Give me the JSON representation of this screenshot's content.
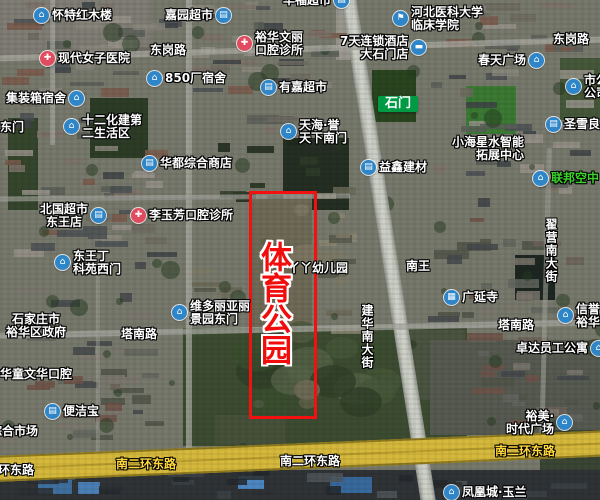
{
  "map": {
    "highlight": {
      "text": "体育公园",
      "color": "#f20d0d",
      "rect": {
        "x": 249,
        "y": 191,
        "w": 62,
        "h": 222
      },
      "text_pos": {
        "x": 257,
        "y": 241
      }
    },
    "colors": {
      "poi_icon_blue": "#2e86c8",
      "medical_icon_red": "#e14b5f",
      "tag_green": "#009944",
      "road_label_yellow": "#ffd83d",
      "green_poi_text": "#3bd42c",
      "expressway_yellow": "#d6b93c"
    },
    "labels": [
      {
        "name": "poi-huaite-hongmulou",
        "kind": "poi",
        "icon": "house",
        "side": "left",
        "x": 34,
        "y": 8,
        "lines": [
          "怀特红木楼"
        ]
      },
      {
        "name": "poi-jiayuan-supermarket",
        "kind": "poi",
        "icon": "shop",
        "side": "right",
        "x": 165,
        "y": 8,
        "lines": [
          "嘉园超市"
        ]
      },
      {
        "name": "poi-huafu-supermarket",
        "kind": "poi",
        "icon": "shop",
        "side": "right",
        "x": 283,
        "y": -7,
        "lines": [
          "华福超市"
        ]
      },
      {
        "name": "poi-hebei-medical-college",
        "kind": "poi",
        "icon": "school",
        "side": "left",
        "x": 393,
        "y": 6,
        "lines": [
          "河北医科大学",
          "临床学院"
        ]
      },
      {
        "name": "road-donggang-left",
        "kind": "road",
        "x": 150,
        "y": 44,
        "lines": [
          "东岗路"
        ]
      },
      {
        "name": "road-donggang-right",
        "kind": "road",
        "x": 553,
        "y": 33,
        "lines": [
          "东岗路"
        ]
      },
      {
        "name": "poi-xiandai-women-hospital",
        "kind": "poi",
        "icon": "medical",
        "side": "left",
        "x": 40,
        "y": 51,
        "lines": [
          "现代女子医院"
        ]
      },
      {
        "name": "poi-yuhua-wenli-dental",
        "kind": "poi",
        "icon": "medical",
        "side": "left",
        "x": 237,
        "y": 31,
        "lines": [
          "裕华文丽",
          "口腔诊所"
        ]
      },
      {
        "name": "poi-7days-hotel",
        "kind": "poi",
        "icon": "hotel",
        "side": "right",
        "align": "right",
        "x": 340,
        "y": 35,
        "lines": [
          "7天连锁酒店",
          "大石门店"
        ]
      },
      {
        "name": "poi-850-dorm",
        "kind": "poi",
        "icon": "house",
        "side": "left",
        "x": 147,
        "y": 71,
        "lines": [
          "850厂宿舍"
        ]
      },
      {
        "name": "poi-jizhuangxiang-dorm",
        "kind": "poi",
        "icon": "house",
        "side": "right",
        "x": 6,
        "y": 91,
        "lines": [
          "集装箱宿舍"
        ]
      },
      {
        "name": "poi-youjia-supermarket",
        "kind": "poi",
        "icon": "shop",
        "side": "left",
        "x": 261,
        "y": 80,
        "lines": [
          "有嘉超市"
        ]
      },
      {
        "name": "poi-chuntian-plaza",
        "kind": "poi",
        "icon": "house",
        "side": "right",
        "x": 478,
        "y": 53,
        "lines": [
          "春天广场"
        ]
      },
      {
        "name": "poi-shi-gong-company",
        "kind": "poi",
        "icon": "house",
        "side": "left",
        "x": 566,
        "y": 74,
        "lines": [
          "市公",
          "公司"
        ]
      },
      {
        "name": "tag-shimen",
        "kind": "tag",
        "x": 378,
        "y": 96,
        "lines": [
          "石门"
        ]
      },
      {
        "name": "poi-shierhuajian-living-area",
        "kind": "poi",
        "icon": "house",
        "side": "left",
        "x": 64,
        "y": 114,
        "lines": [
          "十二化建第",
          "二生活区"
        ]
      },
      {
        "name": "road-dongmen",
        "kind": "road",
        "x": 0,
        "y": 121,
        "lines": [
          "东门"
        ]
      },
      {
        "name": "poi-tianhai-yutianxia-south-gate",
        "kind": "poi",
        "icon": "house",
        "side": "left",
        "x": 281,
        "y": 119,
        "lines": [
          "天海·誉",
          "天下南门"
        ]
      },
      {
        "name": "poi-shengxueliang",
        "kind": "poi",
        "icon": "shop",
        "side": "left",
        "x": 546,
        "y": 117,
        "lines": [
          "圣雪良"
        ]
      },
      {
        "name": "poi-xiaohaixing-center",
        "kind": "poi",
        "align": "right",
        "x": 452,
        "y": 136,
        "lines": [
          "小海星水智能",
          "拓展中心"
        ]
      },
      {
        "name": "poi-huadu-store",
        "kind": "poi",
        "icon": "shop",
        "side": "left",
        "x": 142,
        "y": 156,
        "lines": [
          "华都综合商店"
        ]
      },
      {
        "name": "poi-yixin-building-materials",
        "kind": "poi",
        "icon": "shop",
        "side": "left",
        "x": 361,
        "y": 160,
        "lines": [
          "益鑫建材"
        ]
      },
      {
        "name": "poi-lianbang-kongzhong",
        "kind": "poi_green",
        "icon": "house",
        "side": "left",
        "x": 533,
        "y": 171,
        "lines": [
          "联邦空中"
        ]
      },
      {
        "name": "poi-beiguo-supermarket-dongwang",
        "kind": "poi",
        "icon": "shop",
        "side": "right",
        "align": "center",
        "x": 40,
        "y": 203,
        "lines": [
          "北国超市",
          "东王店"
        ]
      },
      {
        "name": "poi-liyufang-dental",
        "kind": "poi",
        "icon": "medical",
        "side": "left",
        "x": 131,
        "y": 208,
        "lines": [
          "李玉芳口腔诊所"
        ]
      },
      {
        "name": "road-zhaiying-south-street",
        "kind": "road_vertical",
        "x": 544,
        "y": 218,
        "lines": [
          "翟营南大街"
        ]
      },
      {
        "name": "poi-dongwang-keyuan-west-gate",
        "kind": "poi",
        "icon": "house",
        "side": "left",
        "x": 55,
        "y": 250,
        "lines": [
          "东王丁",
          "科苑西门"
        ]
      },
      {
        "name": "road-nanwang",
        "kind": "road",
        "x": 406,
        "y": 260,
        "lines": [
          "南王"
        ]
      },
      {
        "name": "poi-yaya-kindergarten",
        "kind": "poi",
        "x": 288,
        "y": 262,
        "lines": [
          "丫丫幼儿园"
        ]
      },
      {
        "name": "poi-guangyan-temple",
        "kind": "poi",
        "icon": "temple",
        "side": "left",
        "x": 444,
        "y": 290,
        "lines": [
          "广延寺"
        ]
      },
      {
        "name": "poi-victoria-gardens-east-gate",
        "kind": "poi",
        "icon": "house",
        "side": "left",
        "x": 172,
        "y": 300,
        "lines": [
          "维多丽亚丽",
          "景园东门"
        ]
      },
      {
        "name": "poi-xinyu-yuhua",
        "kind": "poi",
        "icon": "house",
        "side": "left",
        "x": 558,
        "y": 303,
        "lines": [
          "信誉",
          "裕华"
        ]
      },
      {
        "name": "road-jianhua-south-street",
        "kind": "road_vertical",
        "x": 360,
        "y": 304,
        "lines": [
          "建华南大街"
        ]
      },
      {
        "name": "poi-shijiazhuang-yuhua-gov",
        "kind": "poi",
        "align": "center",
        "x": 6,
        "y": 313,
        "lines": [
          "石家庄市",
          "裕华区政府"
        ]
      },
      {
        "name": "road-tananlu-left",
        "kind": "road",
        "x": 121,
        "y": 328,
        "lines": [
          "塔南路"
        ]
      },
      {
        "name": "road-tananlu-right",
        "kind": "road",
        "x": 498,
        "y": 319,
        "lines": [
          "塔南路"
        ]
      },
      {
        "name": "poi-zhuoda-staff-apartment",
        "kind": "poi",
        "icon": "house",
        "side": "right",
        "x": 516,
        "y": 341,
        "lines": [
          "卓达员工公寓"
        ]
      },
      {
        "name": "poi-yuhuatong-wenhua-dental",
        "kind": "poi",
        "x": -12,
        "y": 368,
        "lines": [
          "裕华童文华口腔"
        ]
      },
      {
        "name": "poi-bianjiebao",
        "kind": "poi",
        "icon": "shop",
        "side": "left",
        "x": 45,
        "y": 404,
        "lines": [
          "便洁宝"
        ]
      },
      {
        "name": "poi-zonghe-market",
        "kind": "poi",
        "x": -10,
        "y": 425,
        "lines": [
          "综合市场"
        ]
      },
      {
        "name": "poi-yumei-times-plaza",
        "kind": "poi",
        "icon": "house",
        "side": "right",
        "align": "right",
        "x": 506,
        "y": 410,
        "lines": [
          "裕美·",
          "时代广场"
        ]
      },
      {
        "name": "road-nanerhuan-left",
        "kind": "road",
        "x": -2,
        "y": 464,
        "lines": [
          "环东路"
        ]
      },
      {
        "name": "road-nanerhuan-yellow-1",
        "kind": "road_yellow",
        "x": 116,
        "y": 458,
        "lines": [
          "南二环东路"
        ]
      },
      {
        "name": "road-nanerhuan-white",
        "kind": "road",
        "x": 280,
        "y": 455,
        "lines": [
          "南二环东路"
        ]
      },
      {
        "name": "road-nanerhuan-yellow-2",
        "kind": "road_yellow",
        "x": 495,
        "y": 445,
        "lines": [
          "南二环东路"
        ]
      },
      {
        "name": "poi-fenghuangcheng-yulan",
        "kind": "poi",
        "icon": "house",
        "side": "left",
        "x": 444,
        "y": 485,
        "lines": [
          "凤凰城·玉兰"
        ]
      }
    ]
  }
}
